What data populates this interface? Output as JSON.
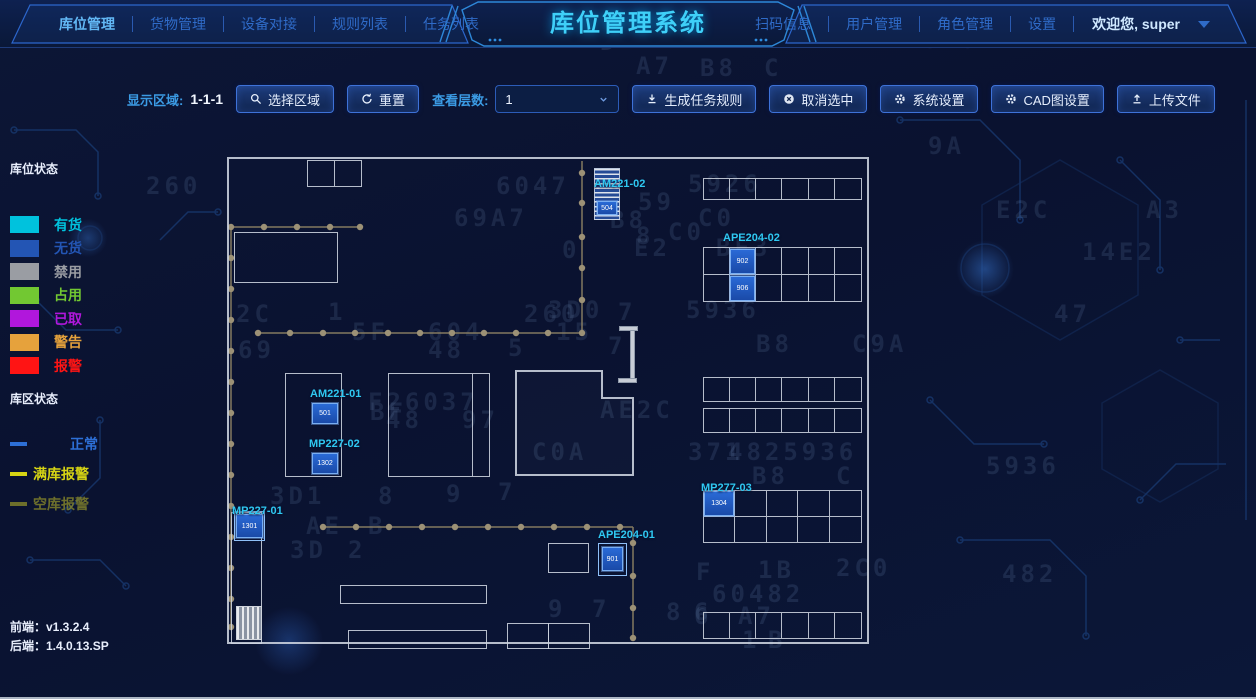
{
  "header": {
    "title": "库位管理系统",
    "left_tabs": [
      {
        "label": "库位管理",
        "active": true
      },
      {
        "label": "货物管理",
        "active": false
      },
      {
        "label": "设备对接",
        "active": false
      },
      {
        "label": "规则列表",
        "active": false
      },
      {
        "label": "任务列表",
        "active": false
      }
    ],
    "right_tabs": [
      {
        "label": "扫码信息"
      },
      {
        "label": "用户管理"
      },
      {
        "label": "角色管理"
      },
      {
        "label": "设置"
      }
    ],
    "welcome": "欢迎您, super"
  },
  "toolbar": {
    "display_area_label": "显示区域:",
    "display_area_value": "1-1-1",
    "select_area_button": "选择区域",
    "reset_button": "重置",
    "layers_label": "查看层数:",
    "layers_value": "1",
    "generate_rules_button": "生成任务规则",
    "cancel_selection_button": "取消选中",
    "system_settings_button": "系统设置",
    "cad_settings_button": "CAD图设置",
    "upload_file_button": "上传文件"
  },
  "legend": {
    "slot_status_title": "库位状态",
    "slot_items": [
      {
        "label": "有货",
        "color": "#00c2dd"
      },
      {
        "label": "无货",
        "color": "#2355b4"
      },
      {
        "label": "禁用",
        "color": "#9a9da3"
      },
      {
        "label": "占用",
        "color": "#72c832"
      },
      {
        "label": "已取",
        "color": "#b117dc"
      },
      {
        "label": "警告",
        "color": "#e6a23c"
      },
      {
        "label": "报警",
        "color": "#ff1414"
      }
    ],
    "zone_status_title": "库区状态",
    "zone_items": [
      {
        "label": "正常",
        "color": "#2d6fd6"
      },
      {
        "label": "满库报警",
        "color": "#d6d414"
      },
      {
        "label": "空库报警",
        "color": "#8f8f2a"
      }
    ]
  },
  "map": {
    "stations": [
      {
        "name": "AM221-02",
        "cells": [
          "504"
        ]
      },
      {
        "name": "APE204-02",
        "cells": [
          "902",
          "906"
        ]
      },
      {
        "name": "AM221-01",
        "cells": [
          "501"
        ]
      },
      {
        "name": "MP227-02",
        "cells": [
          "1302"
        ]
      },
      {
        "name": "MP277-03",
        "cells": [
          "1304"
        ]
      },
      {
        "name": "MP227-01",
        "cells": [
          "1301"
        ]
      },
      {
        "name": "APE204-01",
        "cells": [
          "901"
        ]
      }
    ]
  },
  "footer": {
    "frontend": "前端：v1.3.2.4",
    "backend": "后端：1.4.0.13.SP"
  },
  "background_chars": [
    {
      "t": "D",
      "x": 600,
      "y": 28
    },
    {
      "t": "BE2",
      "x": 690,
      "y": 26
    },
    {
      "t": "F3D04",
      "x": 905,
      "y": 26
    },
    {
      "t": "A7",
      "x": 636,
      "y": 52
    },
    {
      "t": "B8",
      "x": 700,
      "y": 54
    },
    {
      "t": "C",
      "x": 764,
      "y": 54
    },
    {
      "t": "9A",
      "x": 928,
      "y": 132
    },
    {
      "t": "260",
      "x": 146,
      "y": 172
    },
    {
      "t": "6047",
      "x": 496,
      "y": 172
    },
    {
      "t": "5926",
      "x": 688,
      "y": 170
    },
    {
      "t": "69A7",
      "x": 454,
      "y": 204
    },
    {
      "t": "B8",
      "x": 610,
      "y": 206
    },
    {
      "t": "C0",
      "x": 698,
      "y": 204
    },
    {
      "t": "E2C",
      "x": 996,
      "y": 196
    },
    {
      "t": "A3",
      "x": 1146,
      "y": 196
    },
    {
      "t": "0",
      "x": 562,
      "y": 236
    },
    {
      "t": "E2",
      "x": 634,
      "y": 234
    },
    {
      "t": "BF3",
      "x": 716,
      "y": 234
    },
    {
      "t": "14E2",
      "x": 1082,
      "y": 238
    },
    {
      "t": "2C",
      "x": 236,
      "y": 300
    },
    {
      "t": "1",
      "x": 328,
      "y": 298
    },
    {
      "t": "260",
      "x": 524,
      "y": 300
    },
    {
      "t": "7",
      "x": 618,
      "y": 298
    },
    {
      "t": "5936",
      "x": 686,
      "y": 296
    },
    {
      "t": "47",
      "x": 1054,
      "y": 300
    },
    {
      "t": "59",
      "x": 638,
      "y": 188
    },
    {
      "t": "8",
      "x": 636,
      "y": 222
    },
    {
      "t": "C0",
      "x": 668,
      "y": 218
    },
    {
      "t": "69",
      "x": 238,
      "y": 336
    },
    {
      "t": "48",
      "x": 428,
      "y": 336
    },
    {
      "t": "5",
      "x": 508,
      "y": 334
    },
    {
      "t": "7",
      "x": 608,
      "y": 332
    },
    {
      "t": "B8",
      "x": 756,
      "y": 330
    },
    {
      "t": "C9A",
      "x": 852,
      "y": 330
    },
    {
      "t": "BF",
      "x": 370,
      "y": 398
    },
    {
      "t": "AE2C",
      "x": 600,
      "y": 396
    },
    {
      "t": "3D0",
      "x": 548,
      "y": 296
    },
    {
      "t": "5F",
      "x": 352,
      "y": 318
    },
    {
      "t": "604",
      "x": 428,
      "y": 318
    },
    {
      "t": "15",
      "x": 556,
      "y": 318
    },
    {
      "t": "F26037",
      "x": 368,
      "y": 388
    },
    {
      "t": "48",
      "x": 386,
      "y": 406
    },
    {
      "t": "97",
      "x": 462,
      "y": 406
    },
    {
      "t": "C0A",
      "x": 532,
      "y": 438
    },
    {
      "t": "371",
      "x": 688,
      "y": 438
    },
    {
      "t": "4825936",
      "x": 728,
      "y": 438
    },
    {
      "t": "B8",
      "x": 752,
      "y": 462
    },
    {
      "t": "C",
      "x": 836,
      "y": 462
    },
    {
      "t": "5936",
      "x": 986,
      "y": 452
    },
    {
      "t": "3D1",
      "x": 270,
      "y": 482
    },
    {
      "t": "8",
      "x": 378,
      "y": 482
    },
    {
      "t": "9",
      "x": 446,
      "y": 480
    },
    {
      "t": "7",
      "x": 498,
      "y": 478
    },
    {
      "t": "AE",
      "x": 306,
      "y": 512
    },
    {
      "t": "B",
      "x": 368,
      "y": 512
    },
    {
      "t": "3D",
      "x": 290,
      "y": 536
    },
    {
      "t": "2",
      "x": 348,
      "y": 536
    },
    {
      "t": "9",
      "x": 548,
      "y": 595
    },
    {
      "t": "7",
      "x": 592,
      "y": 595
    },
    {
      "t": "8",
      "x": 666,
      "y": 598
    },
    {
      "t": "6",
      "x": 694,
      "y": 598
    },
    {
      "t": "F",
      "x": 696,
      "y": 558
    },
    {
      "t": "1B",
      "x": 758,
      "y": 556
    },
    {
      "t": "2C0",
      "x": 836,
      "y": 554
    },
    {
      "t": "60482",
      "x": 712,
      "y": 580
    },
    {
      "t": "6",
      "x": 694,
      "y": 602
    },
    {
      "t": "A7",
      "x": 738,
      "y": 602
    },
    {
      "t": "1",
      "x": 742,
      "y": 626
    },
    {
      "t": "B",
      "x": 768,
      "y": 626
    },
    {
      "t": "482",
      "x": 1002,
      "y": 560
    }
  ]
}
